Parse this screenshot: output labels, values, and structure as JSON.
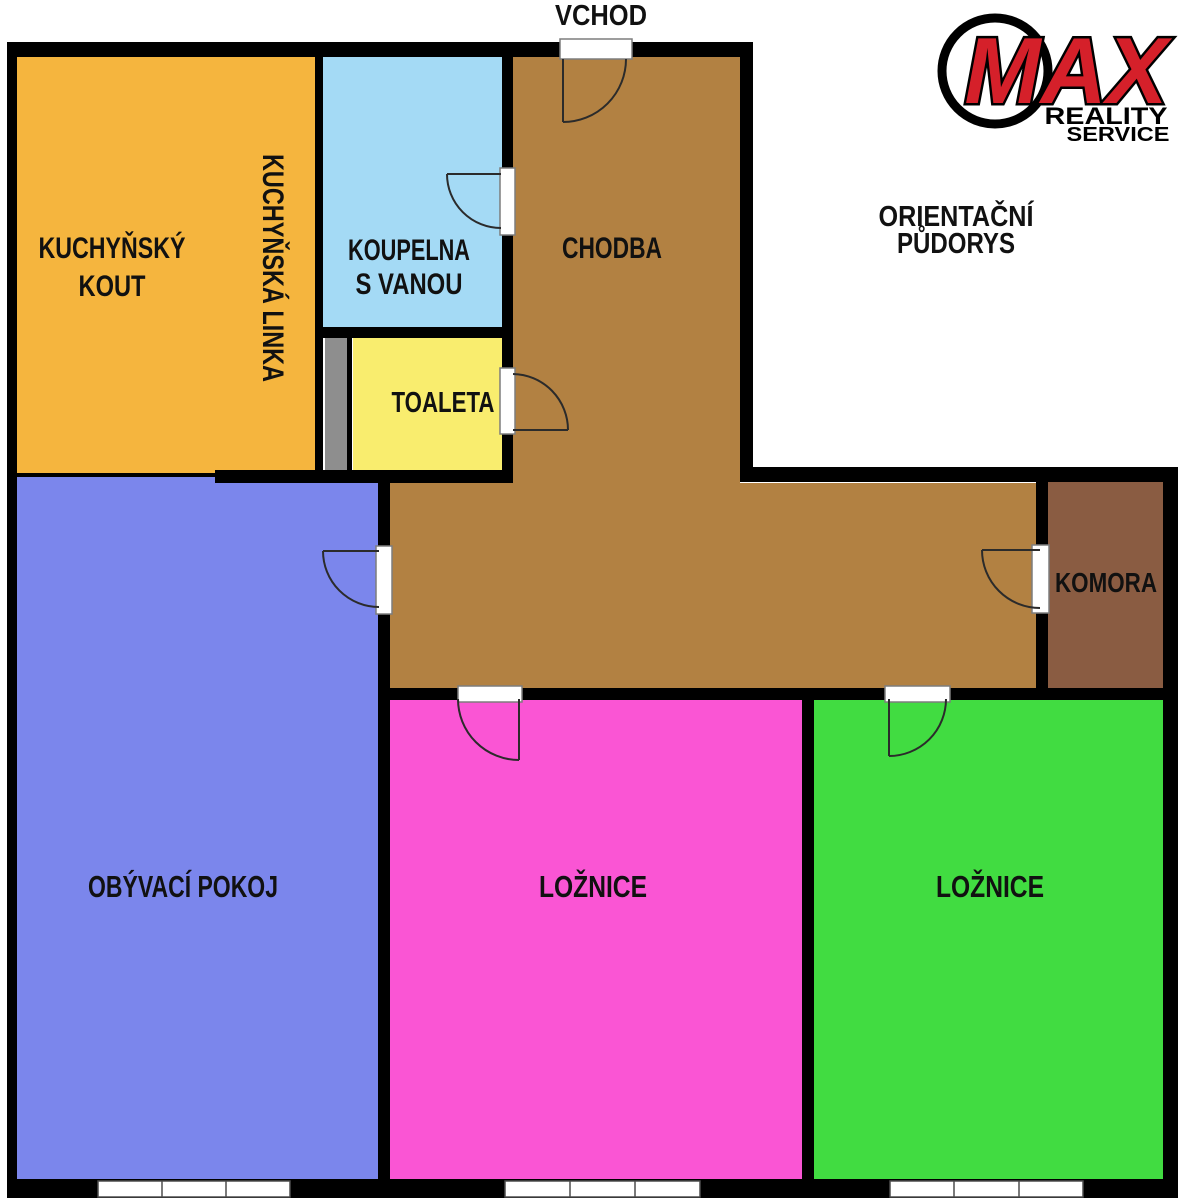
{
  "floorplan": {
    "entrance_label": "VCHOD",
    "plan_title": {
      "line1": "ORIENTAČNÍ",
      "line2": "PŮDORYS"
    },
    "rooms": {
      "kitchen": {
        "name_line1": "KUCHYŇSKÝ",
        "name_line2": "KOUT",
        "color": "#F5B53E"
      },
      "kitchen_counter": {
        "label": "KUCHYŇSKÁ LINKA"
      },
      "bathroom": {
        "name_line1": "KOUPELNA",
        "name_line2": "S VANOU",
        "color": "#A4DAF5"
      },
      "toilet": {
        "label": "TOALETA",
        "color": "#F9ED6E"
      },
      "hallway": {
        "label": "CHODBA",
        "color": "#B28142"
      },
      "storage": {
        "label": "KOMORA",
        "color": "#8A5C42"
      },
      "living_room": {
        "label": "OBÝVACÍ POKOJ",
        "color": "#7B86EC"
      },
      "bedroom_1": {
        "label": "LOŽNICE",
        "color": "#FA55D4"
      },
      "bedroom_2": {
        "label": "LOŽNICE",
        "color": "#41DC41"
      }
    },
    "shaft_color": "#8E8E8E",
    "wall_color": "#000000",
    "label_color": "#111111",
    "logo": {
      "brand": "MAX",
      "brand_color": "#D5202A",
      "line1": "REALITY",
      "line2": "SERVICE"
    }
  }
}
